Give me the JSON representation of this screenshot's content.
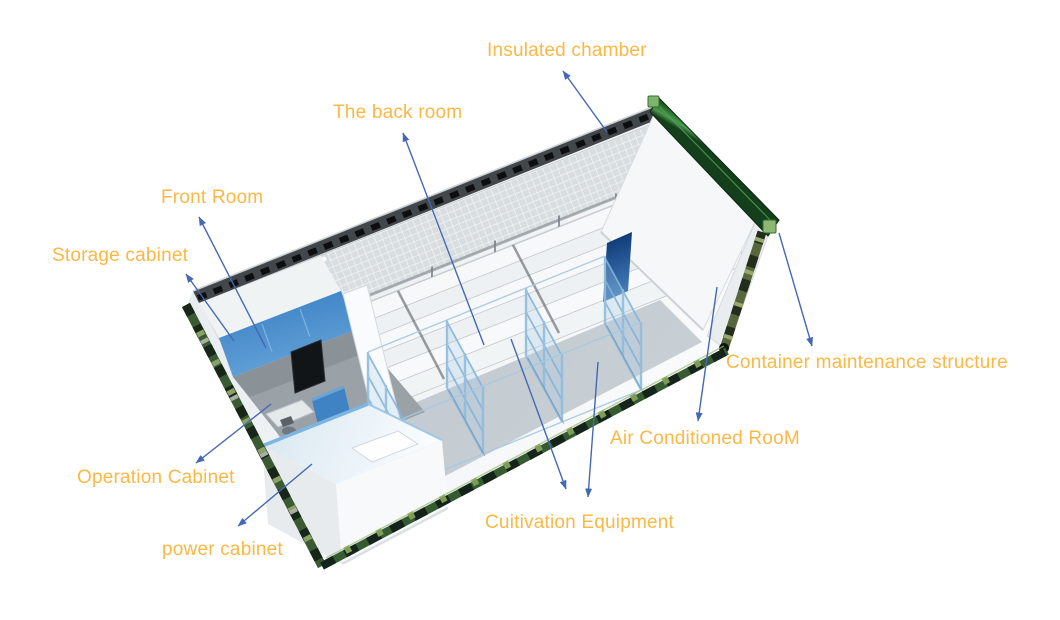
{
  "figure": {
    "type": "3d-cutaway-diagram",
    "subject": "container farm cutaway with annotated rooms and equipment"
  },
  "labels": {
    "insulated_chamber": "Insulated chamber",
    "back_room": "The back room",
    "front_room": "Front Room",
    "storage_cabinet": "Storage cabinet",
    "container_maintenance": "Container maintenance structure",
    "air_conditioned_room": "Air Conditioned RooM",
    "cultivation_equipment": "Cuitivation Equipment",
    "operation_cabinet": "Operation Cabinet",
    "power_cabinet": "power cabinet"
  },
  "colors": {
    "label_text": "#FBB844",
    "arrow": "#4468B4",
    "rail_dark": "#42474B",
    "frame_green": "#2E7C35",
    "corner_green": "#7DB56A",
    "rack_blue": "#84B4DA",
    "wall_blue": "#4287C6",
    "slab_blue": "#123F7E"
  }
}
